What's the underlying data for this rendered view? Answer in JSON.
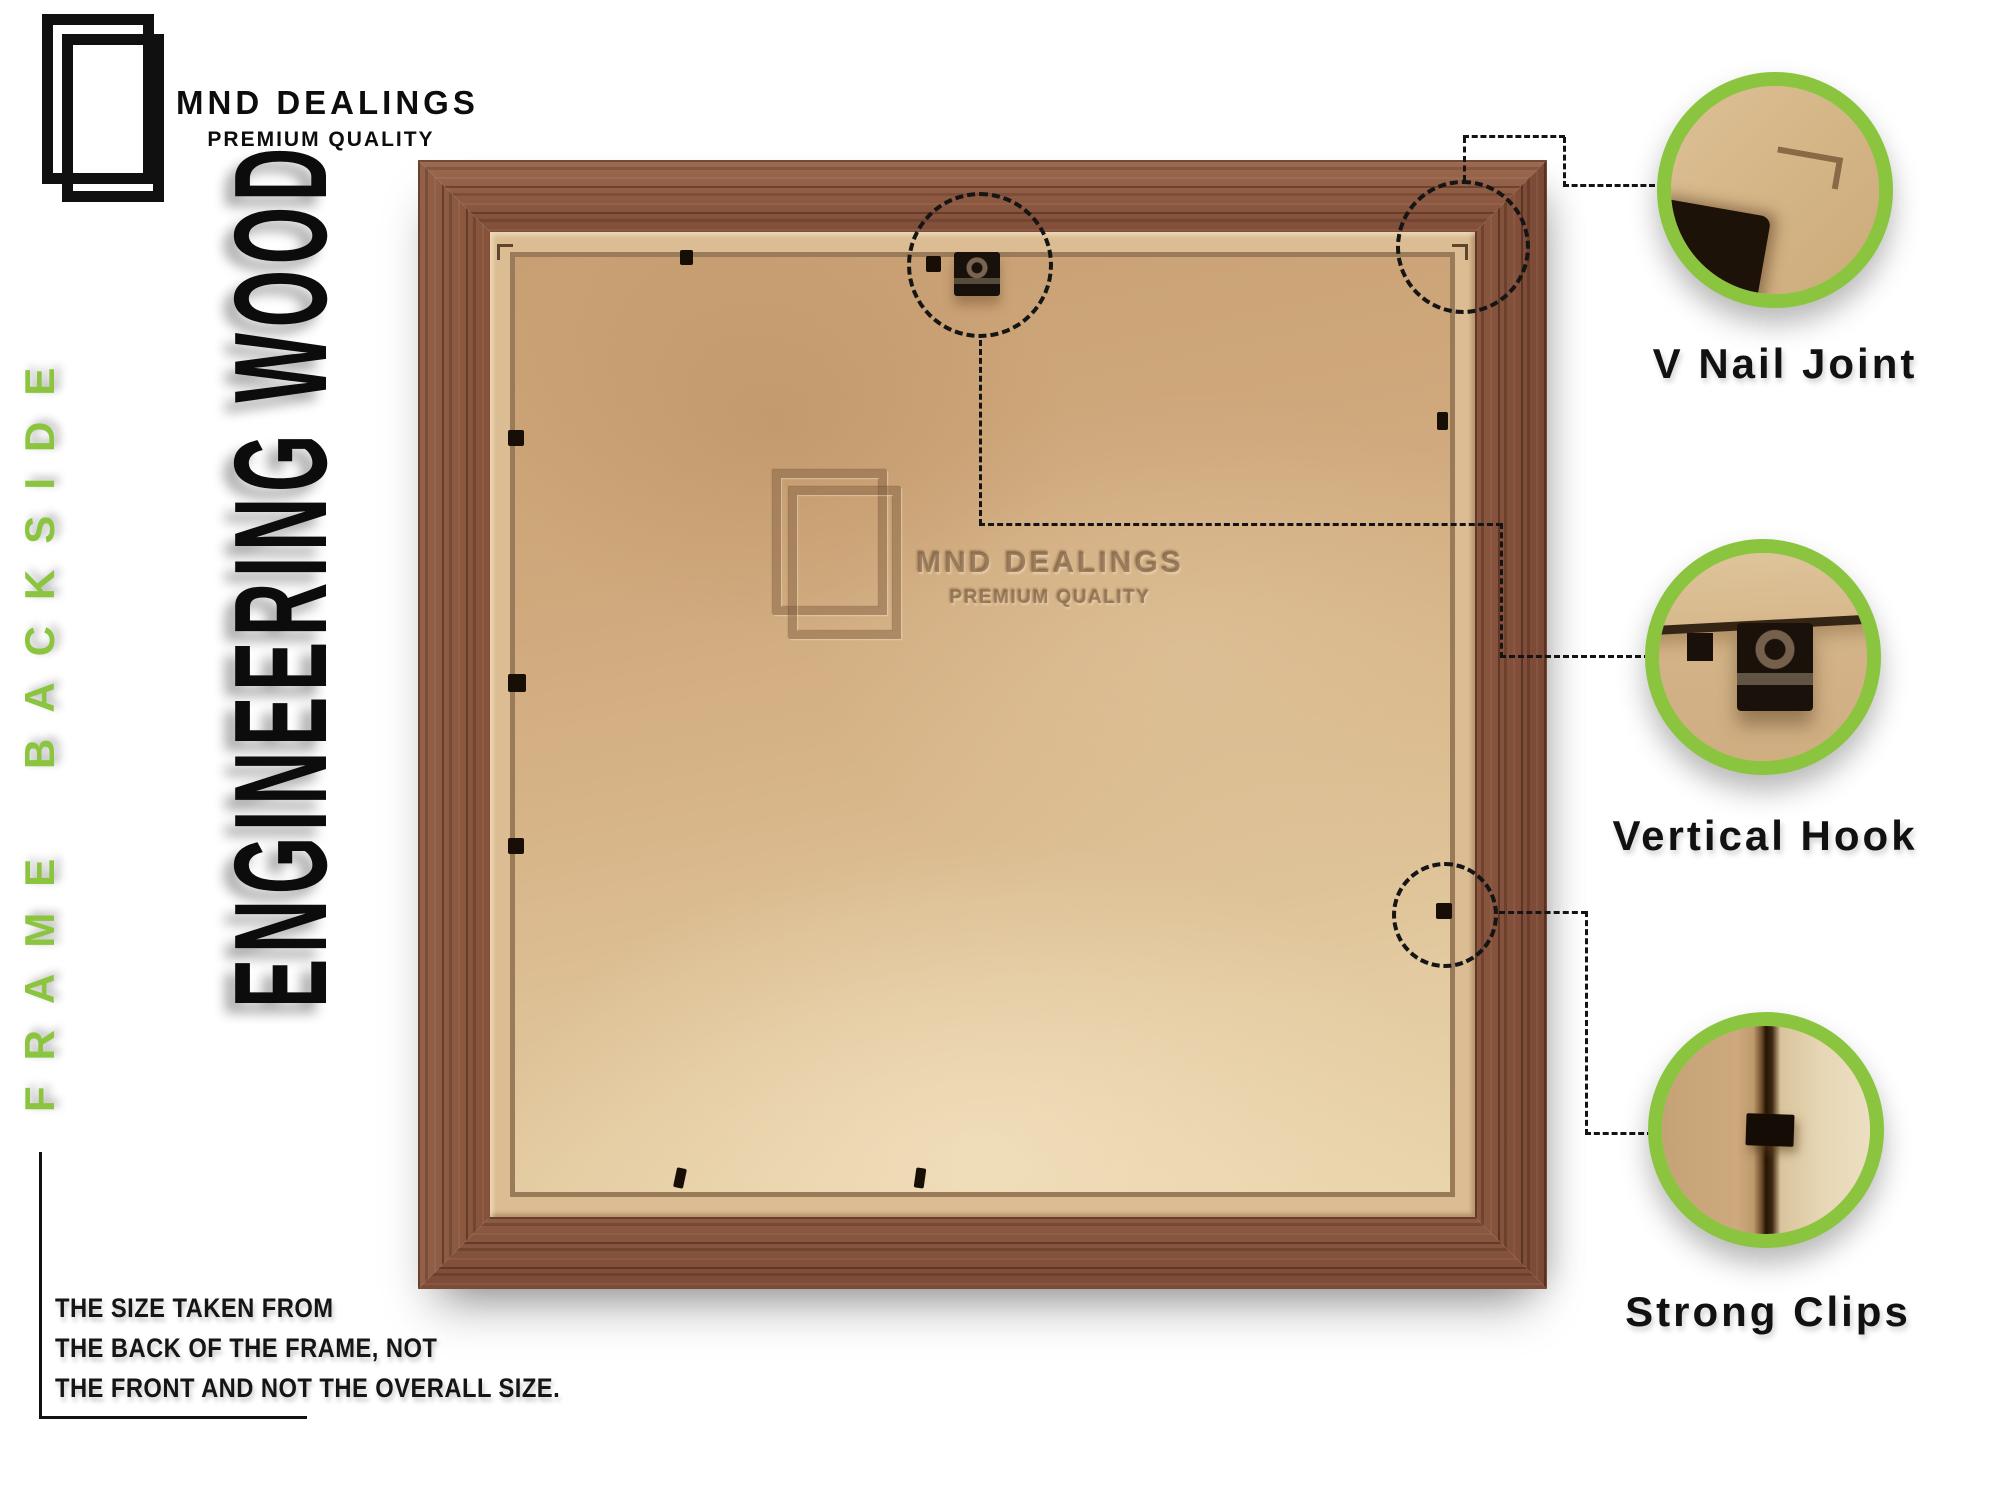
{
  "brand": {
    "name": "MND DEALINGS",
    "tagline": "PREMIUM QUALITY",
    "logo_icon": "double-frame-outline"
  },
  "side_label": "FRAME BACKSIDE",
  "material_label": "ENGINEERING WOOD",
  "watermark": {
    "name": "MND DEALINGS",
    "tagline": "PREMIUM QUALITY",
    "logo_icon": "double-frame-outline-embossed"
  },
  "callouts": [
    {
      "id": "v-nail-joint",
      "label": "V Nail Joint"
    },
    {
      "id": "vertical-hook",
      "label": "Vertical Hook"
    },
    {
      "id": "strong-clips",
      "label": "Strong Clips"
    }
  ],
  "disclaimer": {
    "lines": [
      "THE SIZE TAKEN FROM",
      "THE BACK OF THE FRAME, NOT",
      "THE FRONT AND NOT THE OVERALL SIZE."
    ]
  },
  "colors": {
    "accent_green": "#8bc53f",
    "text_black": "#111111",
    "wood_brown": "#8d5a43",
    "lip_tan": "#dcbd93",
    "board_tan": "#d8b78b",
    "background": "#ffffff"
  }
}
